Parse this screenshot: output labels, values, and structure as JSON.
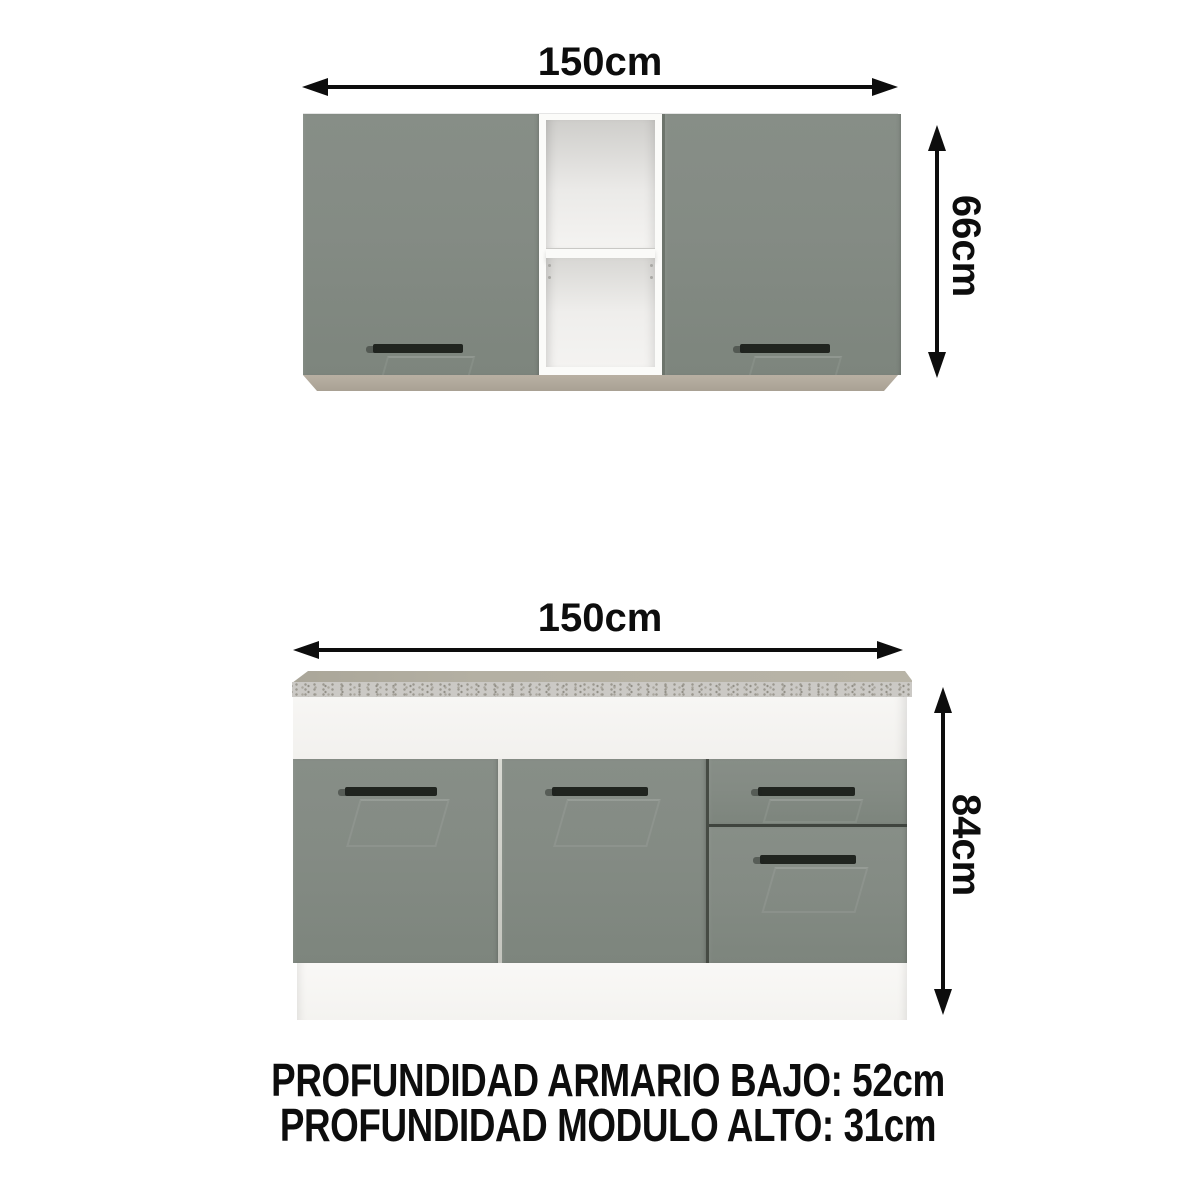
{
  "diagram": {
    "upper_cabinet": {
      "width_label": "150cm",
      "height_label": "66cm"
    },
    "lower_cabinet": {
      "width_label": "150cm",
      "height_label": "84cm"
    },
    "footer": {
      "line1": "PROFUNDIDAD ARMARIO BAJO: 52cm",
      "line2": "PROFUNDIDAD MODULO ALTO: 31cm"
    },
    "colors": {
      "ink": "#0d0d0d",
      "door_grey": "#848b84",
      "door_grey_dark": "#7d857d",
      "handle_black": "#20241f",
      "base_strip_beige": "#b9b0a3",
      "countertop_top": "#b4b0a3",
      "countertop_speckle_base": "#cbc9c5",
      "cabinet_white": "#f2f1ee"
    }
  }
}
